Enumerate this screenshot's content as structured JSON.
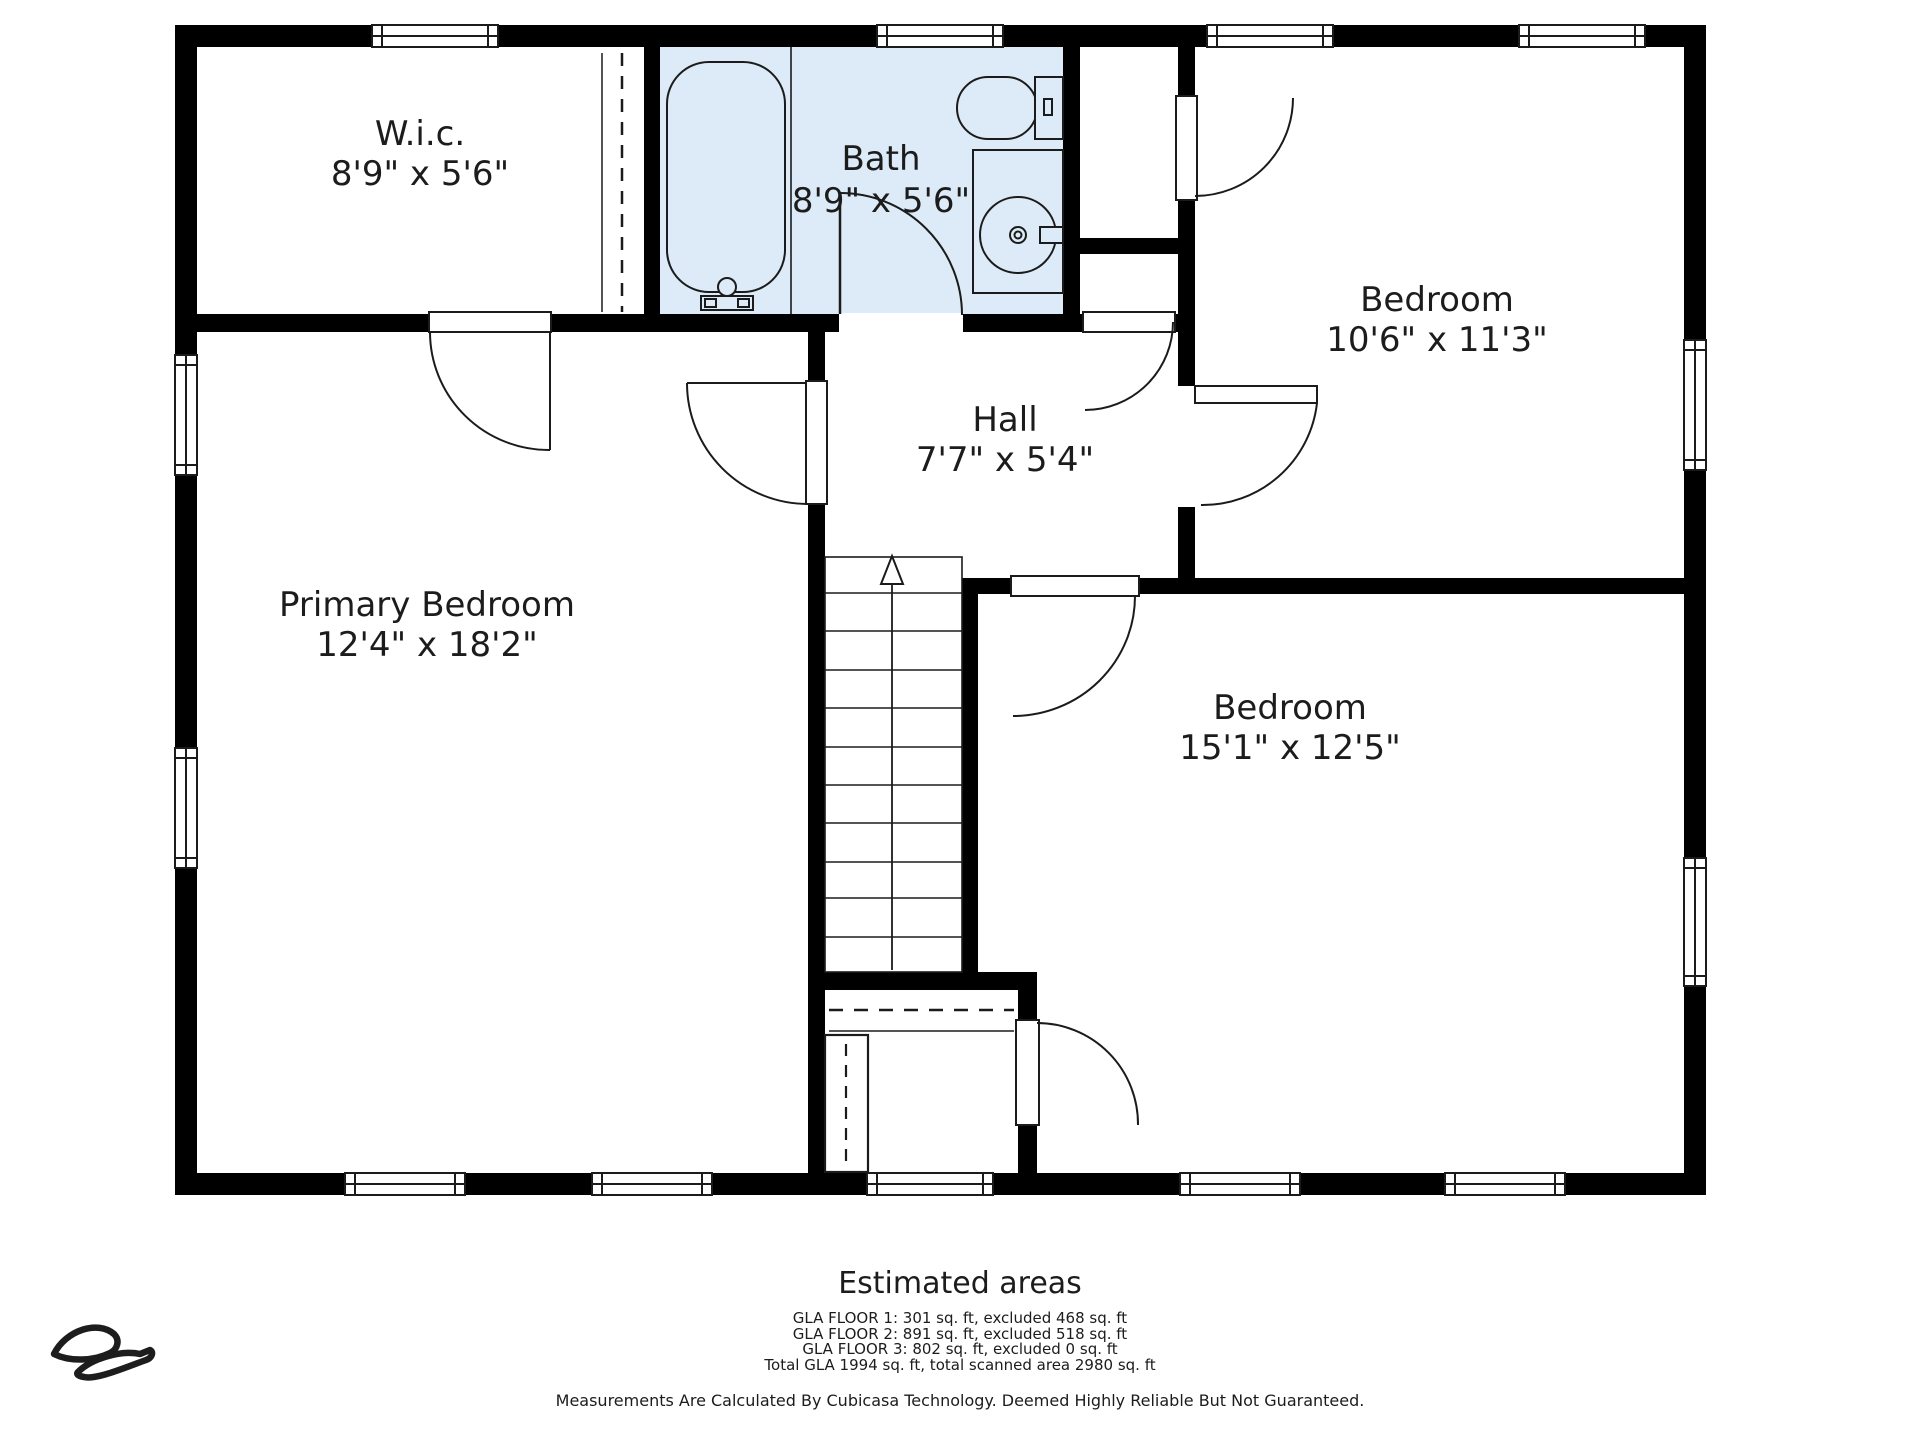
{
  "plan_title": "Floor plan - Floor 3",
  "rooms": [
    {
      "id": "wic",
      "name": "W.i.c.",
      "dims": "8'9\" x 5'6\""
    },
    {
      "id": "bath",
      "name": "Bath",
      "dims": "8'9\" x 5'6\""
    },
    {
      "id": "bedroom-top",
      "name": "Bedroom",
      "dims": "10'6\" x 11'3\""
    },
    {
      "id": "hall",
      "name": "Hall",
      "dims": "7'7\" x 5'4\""
    },
    {
      "id": "primary-bedroom",
      "name": "Primary Bedroom",
      "dims": "12'4\" x 18'2\""
    },
    {
      "id": "bedroom-bottom",
      "name": "Bedroom",
      "dims": "15'1\" x 12'5\""
    }
  ],
  "fixtures": [
    "bathtub",
    "toilet",
    "sink-vanity",
    "stairs-up",
    "under-stair-closet"
  ],
  "areas": {
    "title": "Estimated areas",
    "lines": [
      "GLA FLOOR 1: 301 sq. ft, excluded 468 sq. ft",
      "GLA FLOOR 2: 891 sq. ft, excluded 518 sq. ft",
      "GLA FLOOR 3: 802 sq. ft, excluded 0 sq. ft",
      "Total GLA 1994 sq. ft, total scanned area 2980 sq. ft"
    ]
  },
  "disclaimer": "Measurements Are Calculated By Cubicasa Technology. Deemed Highly Reliable But Not Guaranteed.",
  "colors": {
    "wall": "#000000",
    "bath_fill": "#dcebf7",
    "line": "#1b1b1b",
    "text": "#1c1c1c",
    "background": "#ffffff"
  }
}
